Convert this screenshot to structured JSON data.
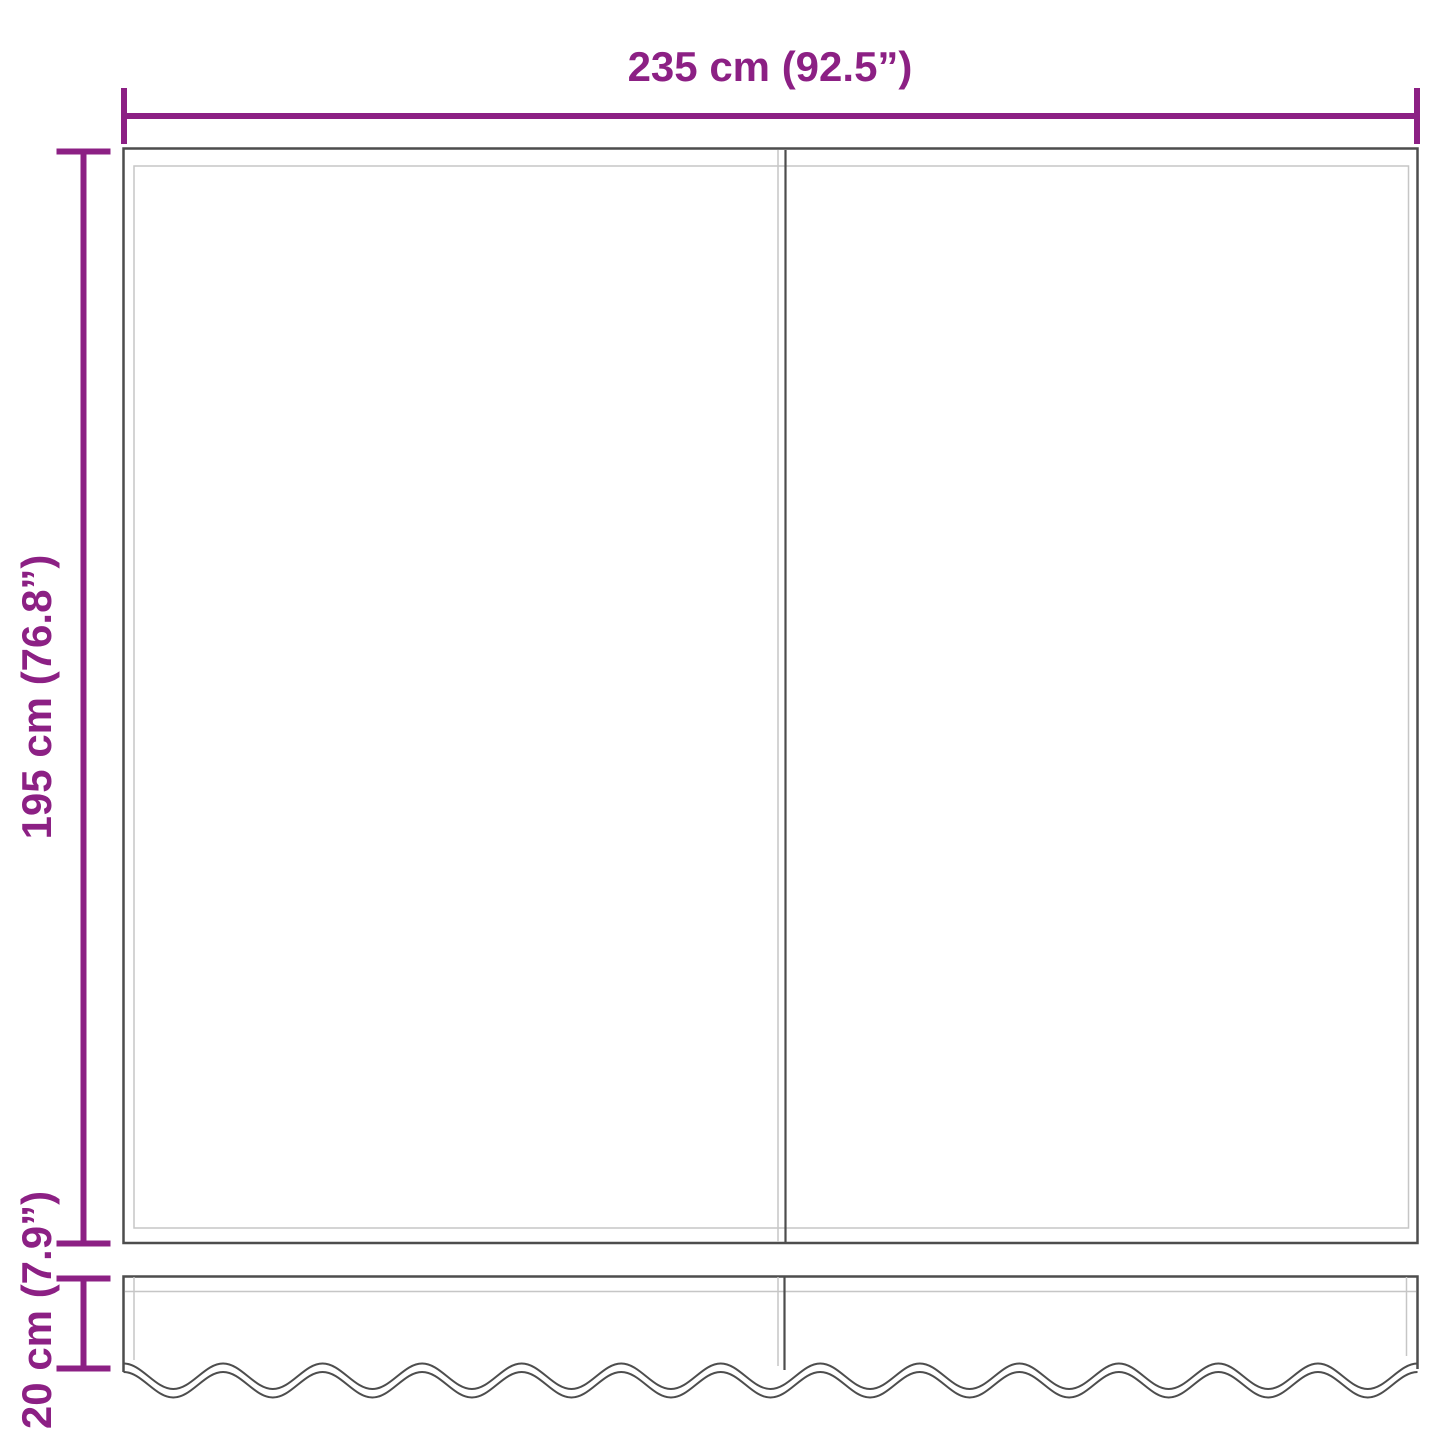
{
  "diagram": {
    "labels": {
      "width": "235 cm (92.5”)",
      "height": "195 cm (76.8”)",
      "valance_height": "20 cm (7.9”)"
    }
  },
  "colors": {
    "accent": "#8C2084",
    "outline_dark": "#4D4D4D",
    "outline_light": "#C6C6C6",
    "background": "#FFFFFF"
  }
}
